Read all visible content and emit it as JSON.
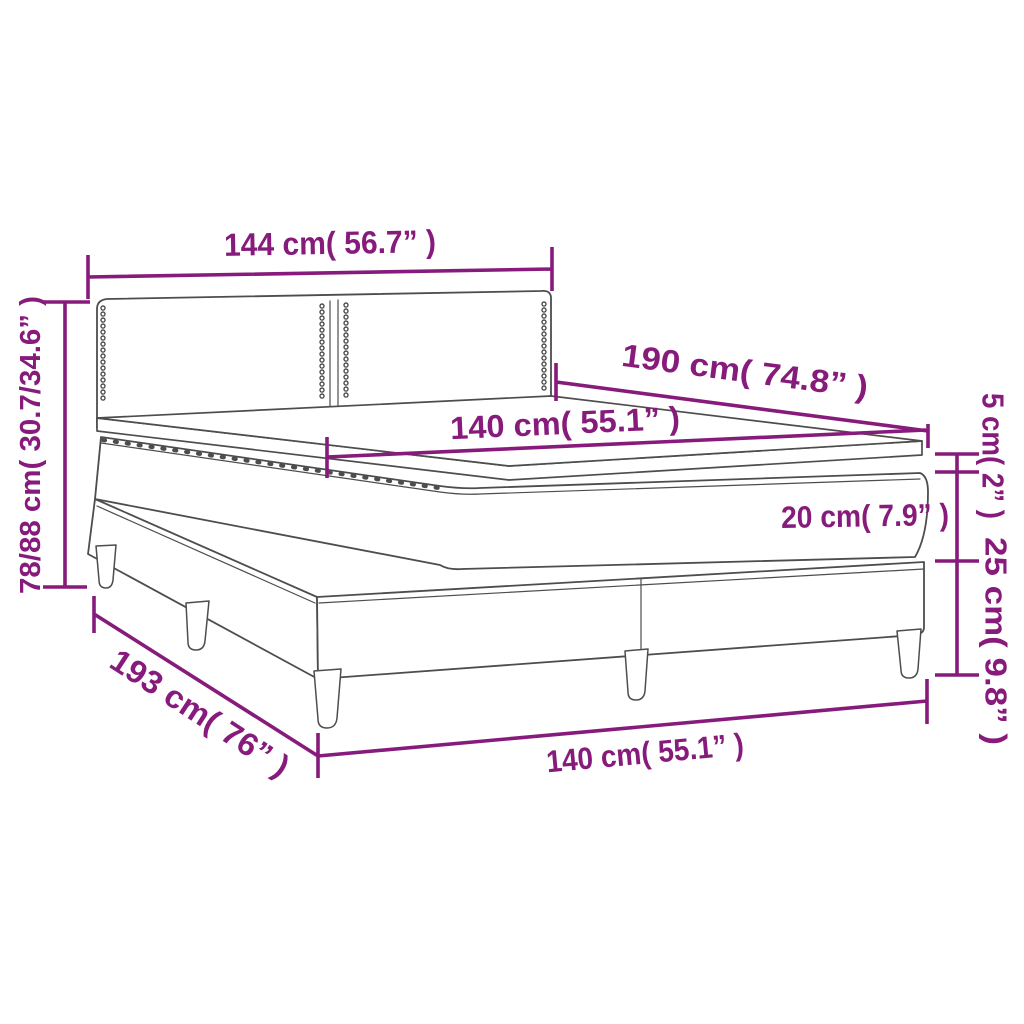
{
  "diagram": {
    "subject": "box spring bed with headboard, mattress and topper – dimension drawing",
    "colors": {
      "dimension_accent": "#871B7B",
      "linework": "#4D4D4D",
      "background": "#FFFFFF"
    },
    "labels": {
      "headboard_width": "144 cm( 56.7” )",
      "total_height": "78/88 cm( 30.7/34.6” )",
      "mattress_length": "190 cm( 74.8” )",
      "mattress_width": "140 cm( 55.1” )",
      "topper_thickness": "5 cm( 2” )",
      "mattress_thickness": "20 cm( 7.9” )",
      "base_height": "25 cm( 9.8” )",
      "base_length": "193 cm( 76” )",
      "base_width": "140 cm( 55.1” )"
    }
  }
}
